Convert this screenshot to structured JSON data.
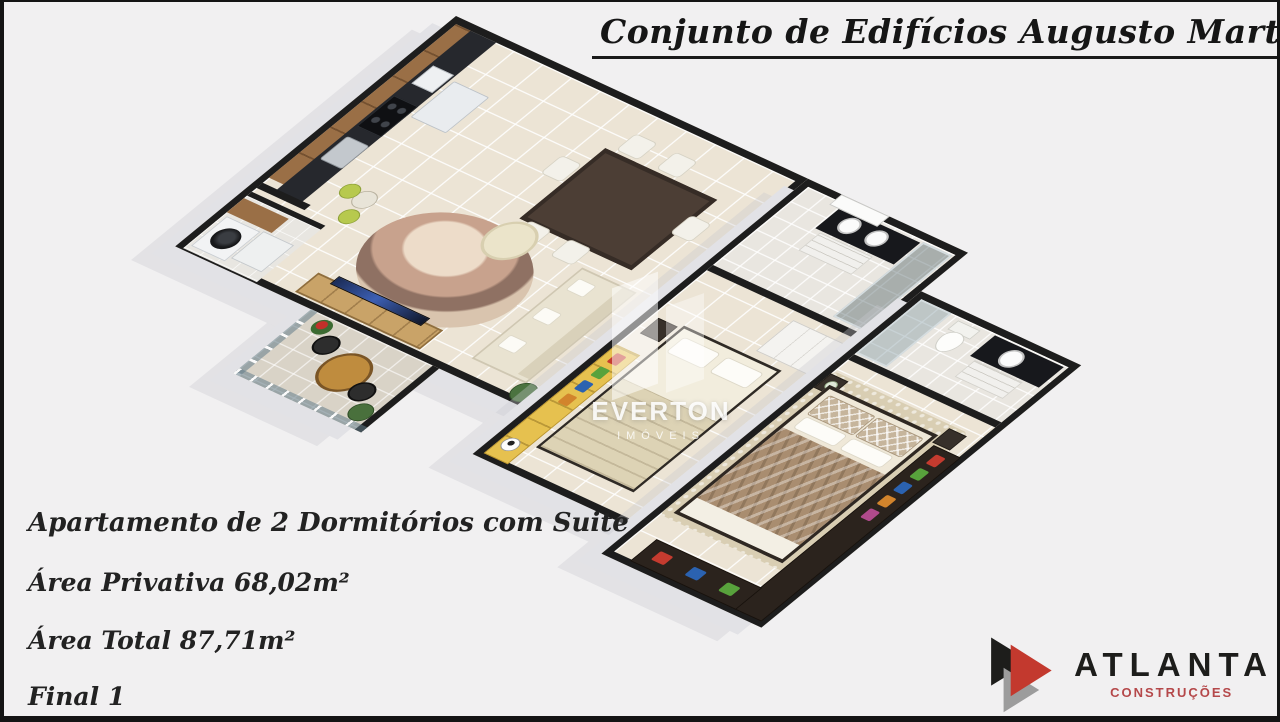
{
  "canvas": {
    "background": "#f1f0f1",
    "frame_color": "#141414"
  },
  "title": {
    "text": "Conjunto de Edifícios Augusto Martins"
  },
  "info": {
    "lines": [
      "Apartamento de 2 Dormitórios com Suite",
      "Área Privativa 68,02m²",
      "Área Total 87,71m²",
      "Final 1"
    ]
  },
  "watermark": {
    "name": "EVERTON",
    "tagline": "IMÓVEIS",
    "icon": "building-slabs-watermark"
  },
  "logo": {
    "name": "ATLANTA",
    "tagline": "CONSTRUÇÕES",
    "icon": "triple-arrow-logo",
    "colors": {
      "black": "#1d1d1b",
      "red": "#c3392e",
      "gray": "#9c9c9c",
      "tagline_red": "#b5484a"
    }
  },
  "floor_plan": {
    "view": "3d-isometric",
    "rooms": [
      "kitchen",
      "laundry",
      "living-dining",
      "balcony",
      "social-bathroom",
      "hall",
      "bedroom",
      "master-suite",
      "ensuite-bathroom"
    ],
    "colors": {
      "wall": "#1d1d1d",
      "slab": "#e2e2e6",
      "floor_tile": "#ece4d5",
      "bath_tile": "#e9e6e0",
      "balcony_tile": "#d9d3c7",
      "cabinet_wood": "#9a6f46",
      "counter_dark": "#17181c",
      "sideboard_wood": "#c9a368",
      "rug_swirl": "#c29e8a",
      "bed_blanket_taupe": "#ab8f72",
      "wardrobe_espresso": "#2b231d",
      "shelf_yellow": "#e6c14f",
      "balcony_table_wood": "#bf8c3e"
    }
  }
}
